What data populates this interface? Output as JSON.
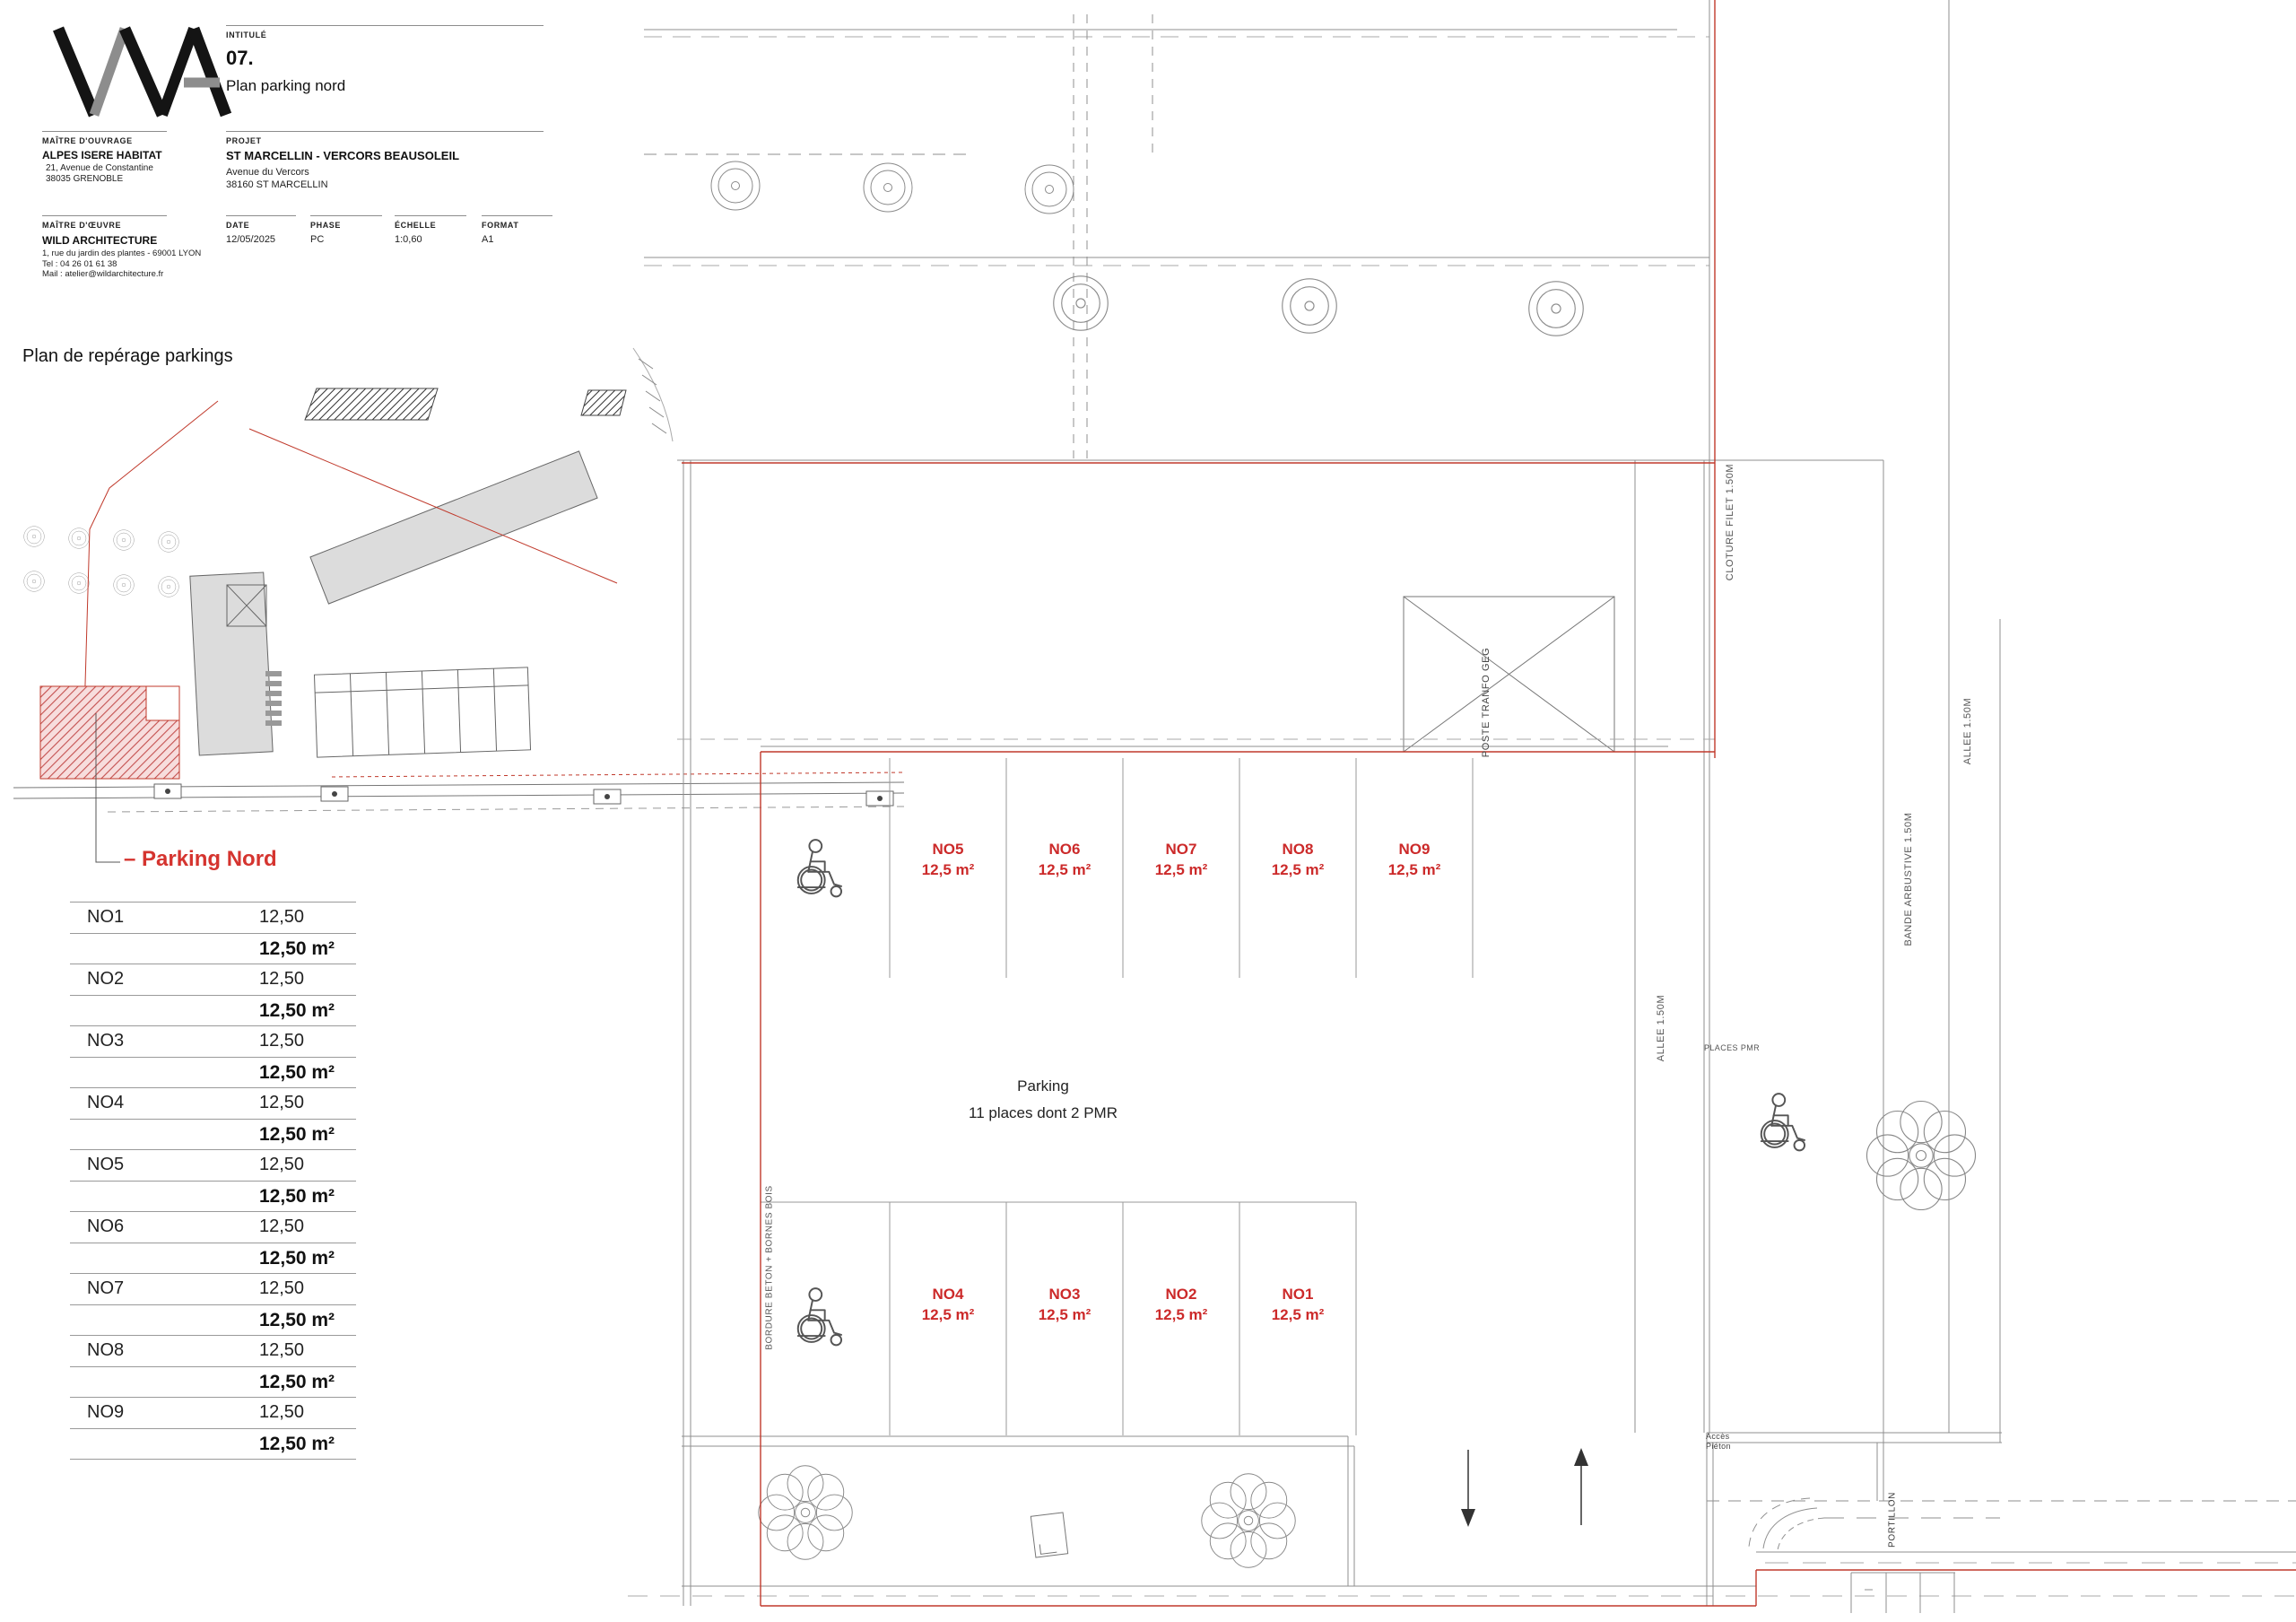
{
  "titleblock": {
    "intitule_label": "INTITULÉ",
    "number": "07.",
    "title": "Plan parking nord",
    "mo_label": "MAÎTRE D'OUVRAGE",
    "mo_name": "ALPES ISERE HABITAT",
    "mo_addr1": "21, Avenue de Constantine",
    "mo_addr2": "38035 GRENOBLE",
    "projet_label": "PROJET",
    "projet_name": "ST MARCELLIN - VERCORS BEAUSOLEIL",
    "projet_addr1": "Avenue du Vercors",
    "projet_addr2": "38160 ST MARCELLIN",
    "moe_label": "MAÎTRE D'ŒUVRE",
    "moe_name": "WILD ARCHITECTURE",
    "moe_addr": "1, rue du jardin des plantes - 69001 LYON",
    "moe_tel": "Tel : 04 26 01 61 38",
    "moe_mail": "Mail : atelier@wildarchitecture.fr",
    "date_label": "DATE",
    "date_value": "12/05/2025",
    "phase_label": "PHASE",
    "phase_value": "PC",
    "scale_label": "ÉCHELLE",
    "scale_value": "1:0,60",
    "format_label": "FORMAT",
    "format_value": "A1"
  },
  "keyplan": {
    "heading": "Plan de repérage parkings",
    "callout": "– Parking Nord"
  },
  "table": {
    "rows": [
      {
        "id": "NO1",
        "value": "12,50",
        "area": "12,50 m²"
      },
      {
        "id": "NO2",
        "value": "12,50",
        "area": "12,50 m²"
      },
      {
        "id": "NO3",
        "value": "12,50",
        "area": "12,50 m²"
      },
      {
        "id": "NO4",
        "value": "12,50",
        "area": "12,50 m²"
      },
      {
        "id": "NO5",
        "value": "12,50",
        "area": "12,50 m²"
      },
      {
        "id": "NO6",
        "value": "12,50",
        "area": "12,50 m²"
      },
      {
        "id": "NO7",
        "value": "12,50",
        "area": "12,50 m²"
      },
      {
        "id": "NO8",
        "value": "12,50",
        "area": "12,50 m²"
      },
      {
        "id": "NO9",
        "value": "12,50",
        "area": "12,50 m²"
      }
    ]
  },
  "plan": {
    "stalls_top": [
      {
        "id": "NO5",
        "area": "12,5 m²"
      },
      {
        "id": "NO6",
        "area": "12,5 m²"
      },
      {
        "id": "NO7",
        "area": "12,5 m²"
      },
      {
        "id": "NO8",
        "area": "12,5 m²"
      },
      {
        "id": "NO9",
        "area": "12,5 m²"
      }
    ],
    "stalls_bottom": [
      {
        "id": "NO4",
        "area": "12,5 m²"
      },
      {
        "id": "NO3",
        "area": "12,5 m²"
      },
      {
        "id": "NO2",
        "area": "12,5 m²"
      },
      {
        "id": "NO1",
        "area": "12,5 m²"
      }
    ],
    "center_line1": "Parking",
    "center_line2": "11 places dont 2 PMR",
    "labels": {
      "cloture": "CLOTURE FILET 1.50M",
      "poste": "POSTE TRANFO GEG",
      "allee_right": "ALLEE 1.50M",
      "bande": "BANDE ARBUSTIVE 1.50M",
      "allee_mid": "ALLEE 1.50M",
      "bordure": "BORDURE BETON + BORNES BOIS",
      "places_pmr": "PLACES PMR",
      "acces1": "Accès",
      "acces2": "Piéton",
      "portillon": "PORTILLON"
    }
  },
  "colors": {
    "boundary_red": "#c0392b",
    "stall_label_red": "#cc2a2a",
    "building_gray": "#dcdcdc"
  }
}
